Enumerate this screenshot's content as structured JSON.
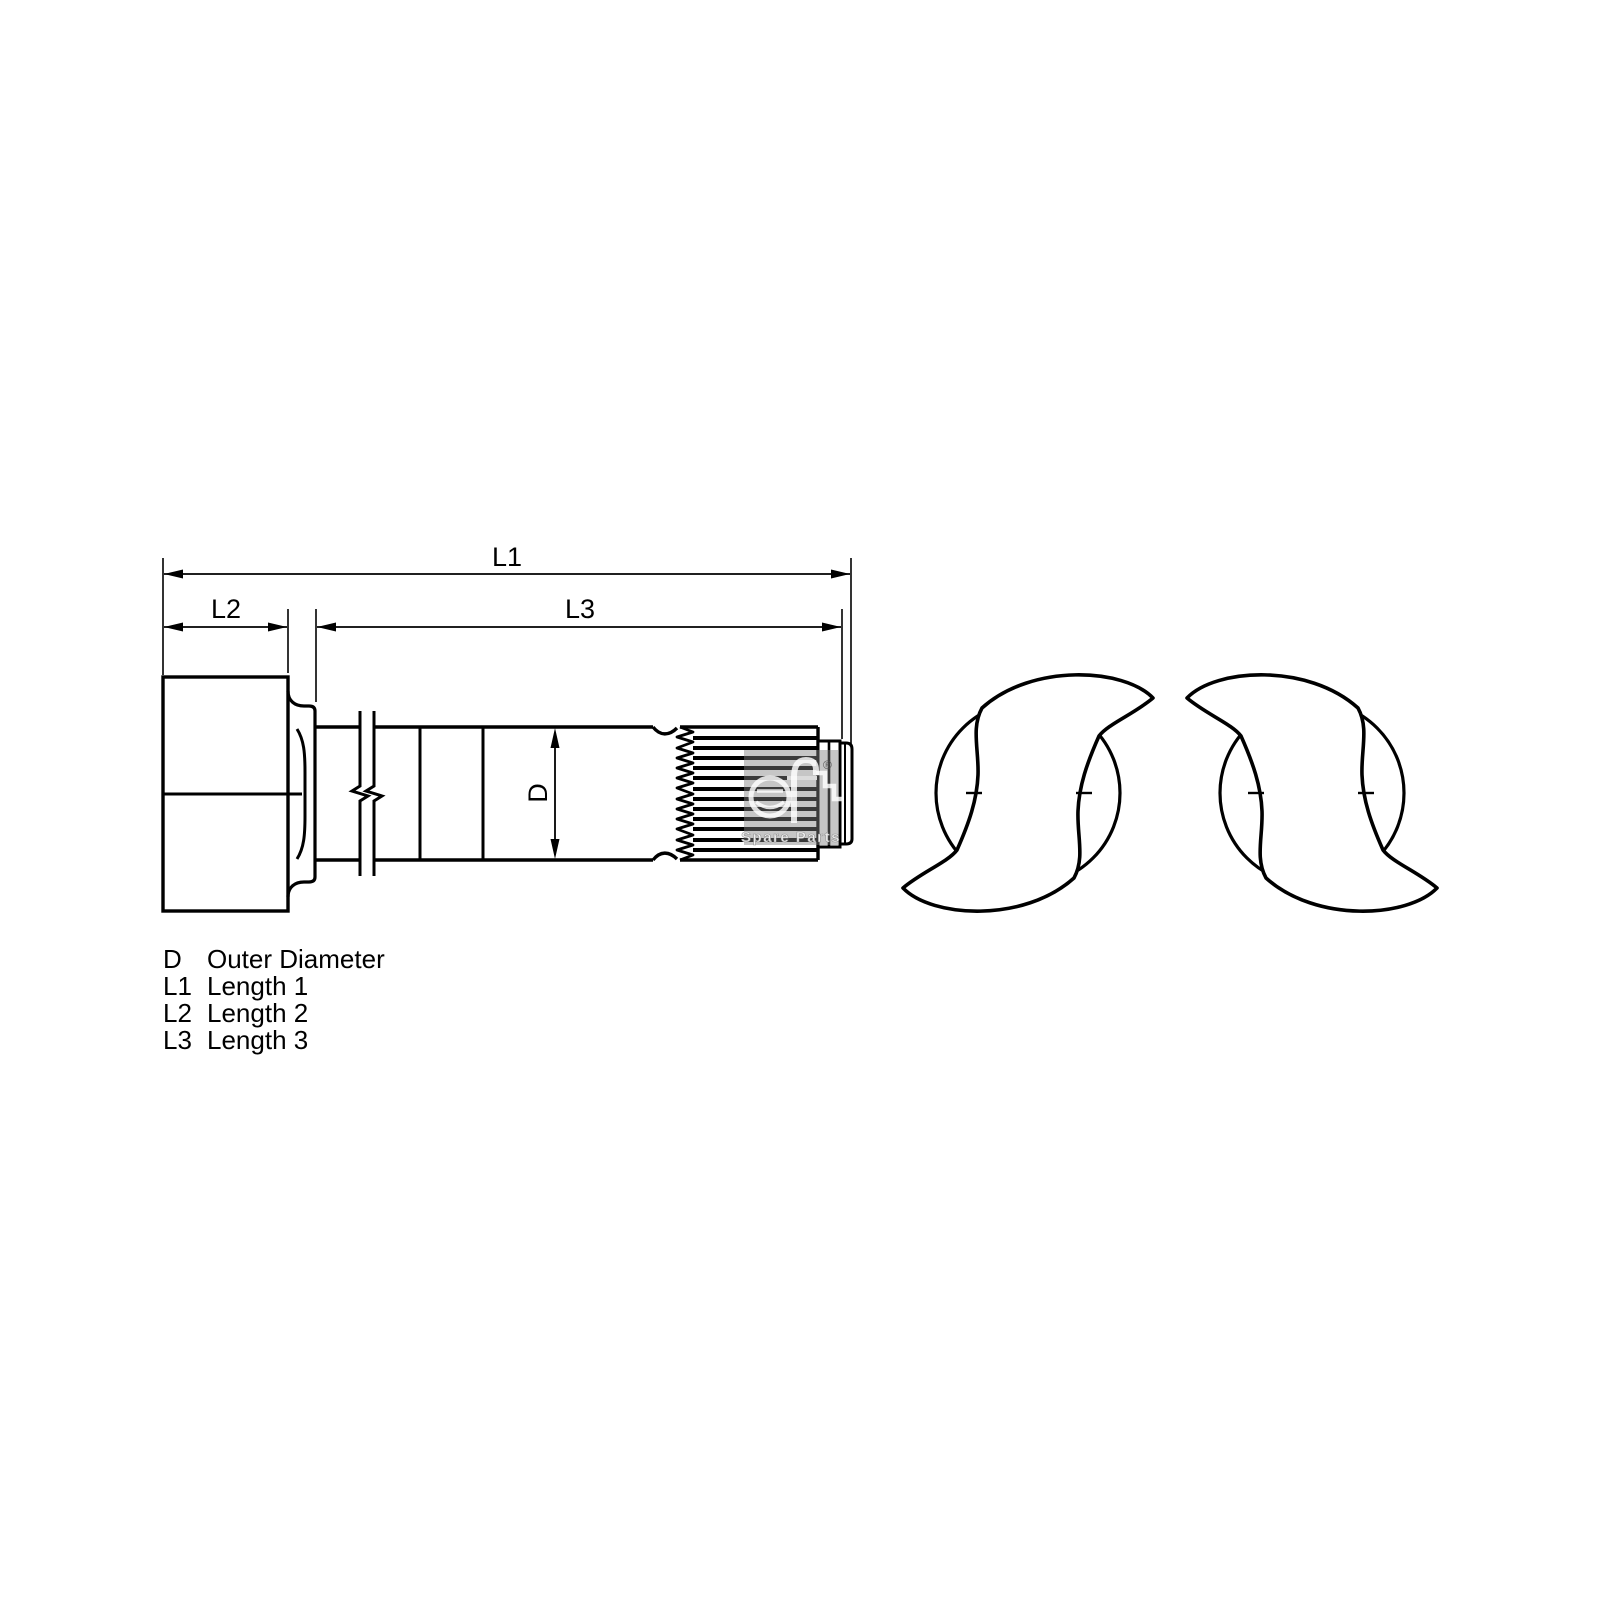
{
  "canvas": {
    "background": "#ffffff",
    "line_color": "#000000",
    "watermark_color": "#808080"
  },
  "dimensions": {
    "l1": "L1",
    "l2": "L2",
    "l3": "L3",
    "d": "D"
  },
  "legend": {
    "rows": [
      {
        "symbol": "D",
        "description": "Outer Diameter"
      },
      {
        "symbol": "L1",
        "description": "Length 1"
      },
      {
        "symbol": "L2",
        "description": "Length 2"
      },
      {
        "symbol": "L3",
        "description": "Length 3"
      }
    ]
  },
  "watermark": {
    "brand": "DT",
    "registered": "®",
    "subtitle": "Spare Parts"
  }
}
